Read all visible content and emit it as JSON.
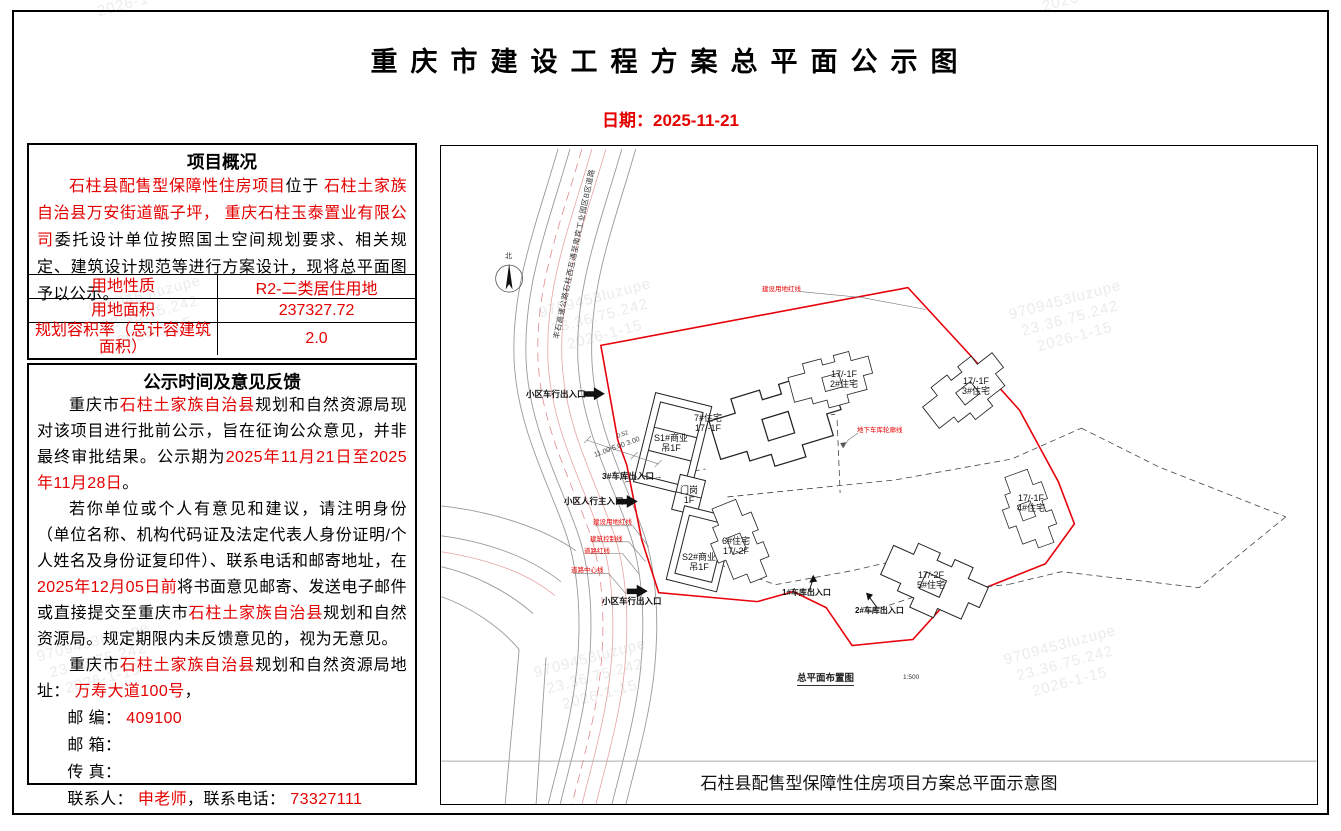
{
  "page": {
    "title": "重庆市建设工程方案总平面公示图",
    "date": "日期：2025-11-21"
  },
  "watermark": {
    "lines": [
      "9709453luzupe",
      "23.36.75.242",
      "2026-1-15"
    ]
  },
  "overview": {
    "header": "项目概况",
    "paragraph": [
      {
        "t": "石柱县配售型保障性住房项目",
        "red": true
      },
      {
        "t": "位于 ",
        "red": false
      },
      {
        "t": "石柱土家族自治县万安街道甑子坪，",
        "red": true
      },
      {
        "t": " ",
        "red": false
      },
      {
        "t": "重庆石柱玉泰置业有限公司",
        "red": true
      },
      {
        "t": "委托设计单位按照国土空间规划要求、相关规定、建筑设计规范等进行方案设计，现将总平面图予以公示。",
        "red": false
      }
    ],
    "table": {
      "rows": [
        {
          "label": "用地性质",
          "value": "R2-二类居住用地"
        },
        {
          "label": "用地面积",
          "value": "237327.72"
        },
        {
          "label": "规划容积率（总计容建筑面积）",
          "value": "2.0"
        }
      ]
    }
  },
  "feedback": {
    "header": "公示时间及意见反馈",
    "para1": [
      {
        "t": "重庆市",
        "red": false
      },
      {
        "t": "石柱土家族自治县",
        "red": true
      },
      {
        "t": "规划和自然资源局现对该项目进行批前公示，旨在征询公众意见，并非最终审批结果。公示期为",
        "red": false
      },
      {
        "t": "2025年11月21日至2025年11月28日",
        "red": true
      },
      {
        "t": "。",
        "red": false
      }
    ],
    "para2": [
      {
        "t": "若你单位或个人有意见和建议，请注明身份（单位名称、机构代码证及法定代表人身份证明/个人姓名及身份证复印件）、联系电话和邮寄地址，在",
        "red": false
      },
      {
        "t": "2025年12月05日前",
        "red": true
      },
      {
        "t": "将书面意见邮寄、发送电子邮件或直接提交至重庆市",
        "red": false
      },
      {
        "t": "石柱土家族自治县",
        "red": true
      },
      {
        "t": "规划和自然资源局。规定期限内未反馈意见的，视为无意见。",
        "red": false
      }
    ],
    "para3": [
      {
        "t": "重庆市",
        "red": false
      },
      {
        "t": "石柱土家族自治县",
        "red": true
      },
      {
        "t": "规划和自然资源局地址： ",
        "red": false
      },
      {
        "t": "万寿大道100号",
        "red": true
      },
      {
        "t": "，",
        "red": false
      }
    ],
    "contact1": [
      {
        "t": "邮 编： ",
        "red": false
      },
      {
        "t": "409100",
        "red": true
      }
    ],
    "contact2": [
      {
        "t": "邮 箱：",
        "red": false
      }
    ],
    "contact3": [
      {
        "t": "传 真：",
        "red": false
      }
    ],
    "contact4": [
      {
        "t": "联系人： ",
        "red": false
      },
      {
        "t": "申老师",
        "red": true
      },
      {
        "t": "，联系电话： ",
        "red": false
      },
      {
        "t": "73327111",
        "red": true
      }
    ]
  },
  "map": {
    "road_name": "丰石高速公路石柱西互通至南宾工业园区B区道路",
    "north": "北",
    "boundary_label": "建设用地红线",
    "garage_outline_label": "地下车库轮廓线",
    "line_labels": [
      "建设用地红线",
      "建筑控制线",
      "道路红线",
      "道路中心线"
    ],
    "dimensions": "11.00 5.00 3.00",
    "dimension_extra": "0.52",
    "entrances": [
      {
        "label": "小区车行出入口"
      },
      {
        "label": "3#车库出入口→"
      },
      {
        "label": "小区人行主入口"
      },
      {
        "label": "小区车行出入口"
      },
      {
        "label": "1#车库出入口"
      },
      {
        "label": "2#车库出入口"
      }
    ],
    "buildings": [
      {
        "line1": "S1#商业",
        "line2": "吊1F"
      },
      {
        "line1": "7#住宅",
        "line2": "17/-1F"
      },
      {
        "line1": "门岗",
        "line2": "1F"
      },
      {
        "line1": "S2#商业",
        "line2": "吊1F"
      },
      {
        "line1": "6#住宅",
        "line2": "17/-2F"
      },
      {
        "line1": "17/-1F",
        "line2": "2#住宅"
      },
      {
        "line1": "17/-1F",
        "line2": "3#住宅"
      },
      {
        "line1": "17/-1F",
        "line2": "4#住宅"
      },
      {
        "line1": "17/-2F",
        "line2": "5#住宅"
      }
    ],
    "plan_label": "总平面布置图",
    "plan_scale": "1:500",
    "caption": "石柱县配售型保障性住房项目方案总平面示意图"
  }
}
